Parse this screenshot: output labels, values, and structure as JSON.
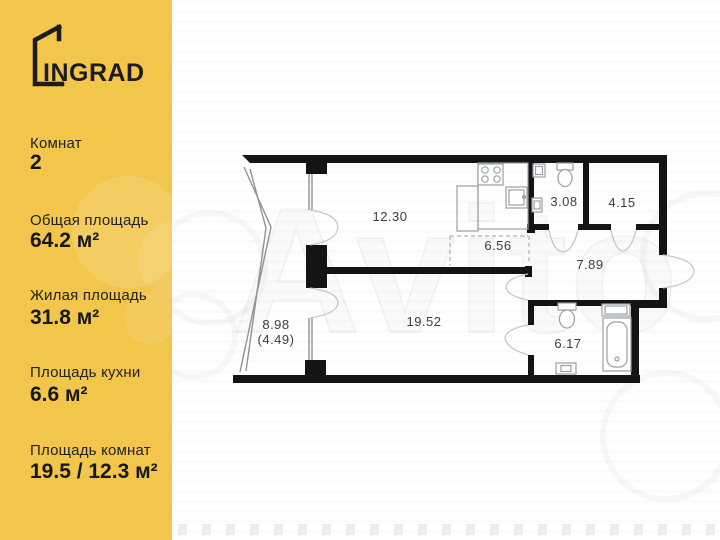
{
  "brand": {
    "logo_text": "INGRAD"
  },
  "sidebar": {
    "stats": [
      {
        "label": "Комнат",
        "value": "2"
      },
      {
        "label": "Общая площадь",
        "value": "64.2 м²"
      },
      {
        "label": "Жилая площадь",
        "value": "31.8 м²"
      },
      {
        "label": "Площадь кухни",
        "value": "6.6 м²"
      },
      {
        "label": "Площадь комнат",
        "value": "19.5 / 12.3 м²"
      }
    ]
  },
  "plan": {
    "rooms": [
      {
        "name": "room-1",
        "area_label": "12.30"
      },
      {
        "name": "kitchen-zone",
        "area_label": "6.56"
      },
      {
        "name": "bathroom-small",
        "area_label": "3.08"
      },
      {
        "name": "wardrobe",
        "area_label": "4.15"
      },
      {
        "name": "hallway",
        "area_label": "7.89"
      },
      {
        "name": "room-2",
        "area_label": "19.52"
      },
      {
        "name": "bathroom",
        "area_label": "6.17"
      },
      {
        "name": "balcony",
        "area_label": "8.98",
        "area_label_secondary": "(4.49)"
      }
    ]
  },
  "watermark": {
    "text": "Avito"
  },
  "colors": {
    "brand_yellow": "#F2C54B",
    "wall_black": "#141414",
    "label_gray": "#3d3d3d"
  }
}
